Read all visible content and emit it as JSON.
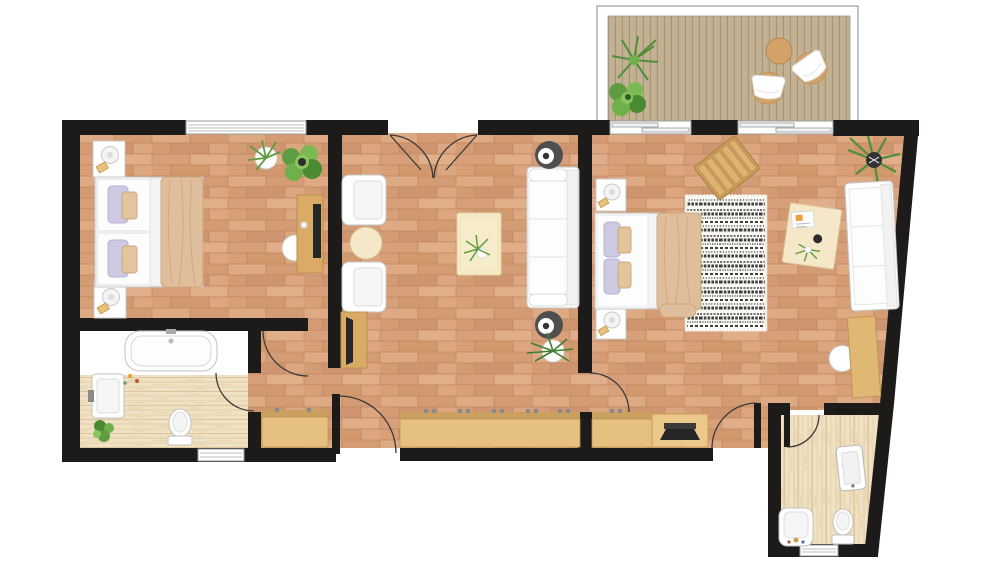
{
  "plan": {
    "type": "apartment-floor-plan",
    "rooms": [
      {
        "name": "terrace",
        "floor": "wood-decking",
        "items": [
          "palm-plant",
          "shrub-plant",
          "round-table",
          "lounge-chair",
          "lounge-chair"
        ]
      },
      {
        "name": "bedroom-1",
        "floor": "terracotta-brick",
        "items": [
          "nightstand-with-lamp",
          "twin-bed",
          "nightstand-with-lamp",
          "desk-with-monitor",
          "desk-chair",
          "potted-plant",
          "potted-plant",
          "window"
        ]
      },
      {
        "name": "living-room",
        "floor": "terracotta-brick",
        "items": [
          "armchair",
          "round-side-table",
          "armchair",
          "tv-console",
          "coffee-table-with-plant",
          "sofa",
          "floor-speaker",
          "floor-speaker",
          "potted-plant",
          "double-door"
        ]
      },
      {
        "name": "bedroom-2",
        "floor": "terracotta-brick",
        "items": [
          "nightstand-with-lamp",
          "double-bed",
          "nightstand-with-lamp",
          "patterned-rug",
          "slatted-bench",
          "writing-desk-with-papers",
          "palm-plant",
          "sofa",
          "side-desk",
          "desk-chair",
          "sideboard-with-laptop",
          "window",
          "window"
        ]
      },
      {
        "name": "bathroom-1",
        "floor": "wood-plank",
        "items": [
          "bathtub",
          "washbasin",
          "toilet",
          "plant",
          "window"
        ]
      },
      {
        "name": "bathroom-2",
        "floor": "wood-plank",
        "items": [
          "mirror-cabinet",
          "washbasin",
          "toilet",
          "window",
          "door"
        ]
      },
      {
        "name": "hallway",
        "floor": "terracotta-brick",
        "items": [
          "cabinet",
          "entrance-door",
          "long-sideboard"
        ]
      }
    ]
  },
  "colors": {
    "background": "#ffffff",
    "wall": "#1d1b19",
    "brick_base": "#d7a078",
    "brick_light": "#e0ae88",
    "brick_dark": "#cf9570",
    "brick_line": "#c08760",
    "wood_floor": "#efe1c1",
    "wood_grain": "#e0c9a2",
    "deck": "#c2b193",
    "deck_line": "#a6926e",
    "furniture_wood": "#e5c07f",
    "furniture_wood_dark": "#c79d5c",
    "desk_wood": "#d9ab66",
    "white_furniture": "#ffffff",
    "furniture_outline": "#c7c7c7",
    "cream": "#f5e8c8",
    "blanket_tan": "#dfbf9b",
    "pillow_lavender": "#cdc9e2",
    "plant_green": "#62a23e",
    "plant_dark_green": "#2f6b2c",
    "rug_white": "#fbfaf5",
    "rug_black": "#1e1e1e",
    "door_arc": "#3a3a3a",
    "window_frame": "#9a9a9a",
    "device_dark": "#262626"
  }
}
